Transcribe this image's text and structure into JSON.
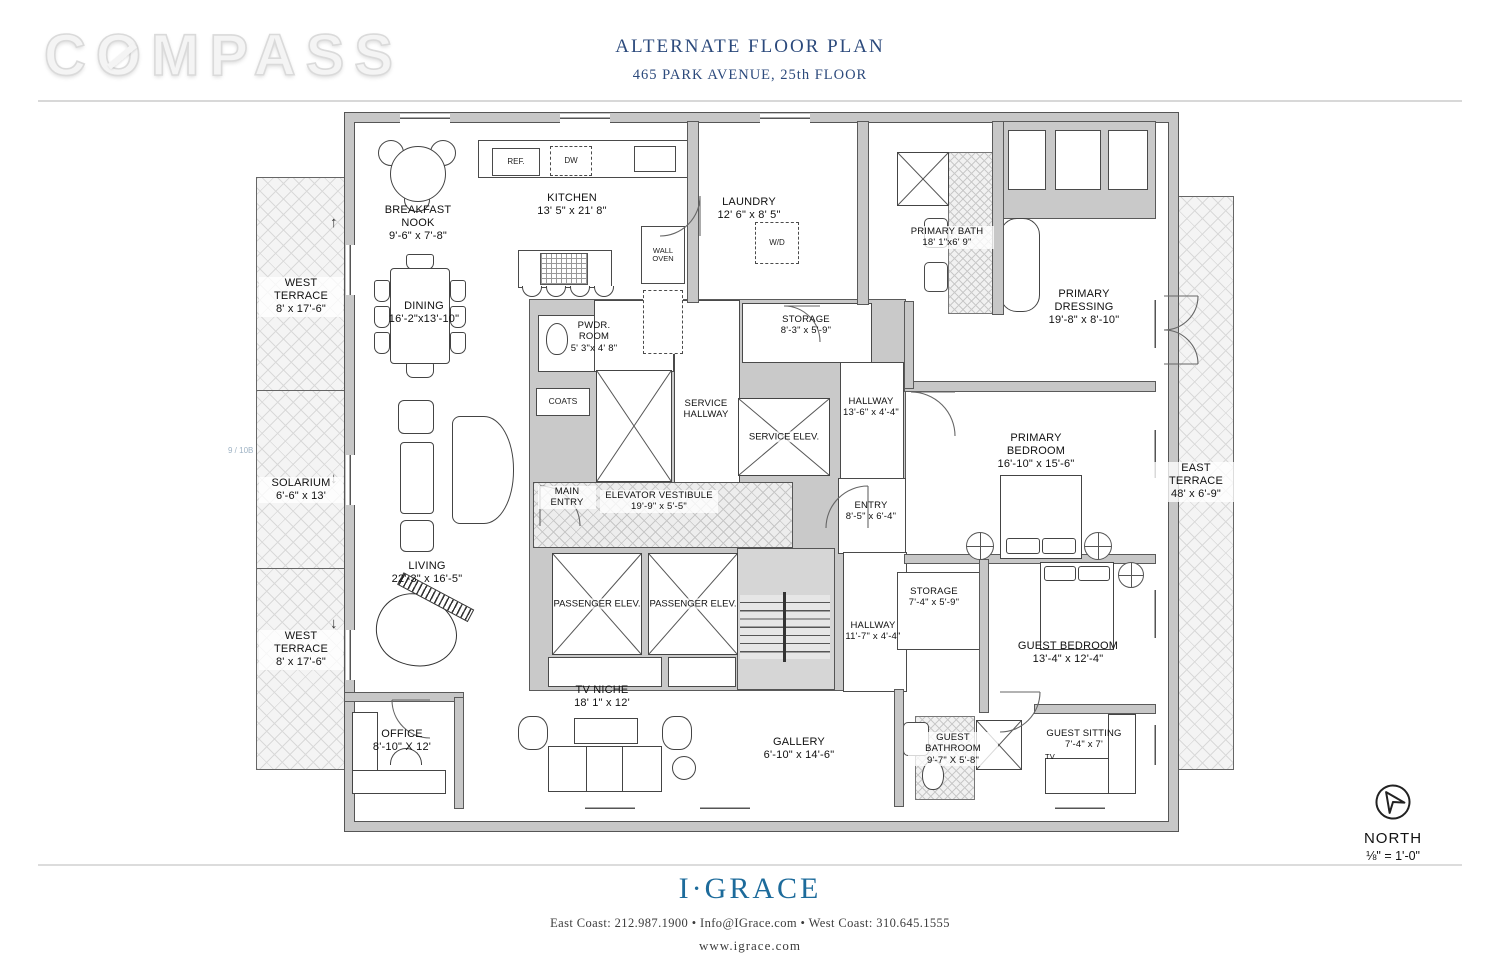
{
  "brand": {
    "pre": "C",
    "o": "O",
    "post": "MPASS"
  },
  "title": {
    "main": "ALTERNATE FLOOR PLAN",
    "sub": "465 PARK AVENUE, 25th FLOOR"
  },
  "colors": {
    "title_blue": "#2c4a7c",
    "igrace_blue": "#1d6b9b",
    "wall_gray": "#c7c7c7"
  },
  "rooms": [
    {
      "name": "BREAKFAST NOOK",
      "dims": "9'-6\" x 7'-8\""
    },
    {
      "name": "KITCHEN",
      "dims": "13' 5\" x 21' 8\""
    },
    {
      "name": "LAUNDRY",
      "dims": "12' 6\" x 8' 5\""
    },
    {
      "name": "PRIMARY BATH",
      "dims": "18' 1\"x6' 9\""
    },
    {
      "name": "PRIMARY DRESSING",
      "dims": "19'-8\" x 8'-10\""
    },
    {
      "name": "WEST TERRACE",
      "dims": "8' x 17'-6\""
    },
    {
      "name": "DINING",
      "dims": "16'-2\"x13'-10\""
    },
    {
      "name": "PWDR. ROOM",
      "dims": "5' 3\"x 4' 8\""
    },
    {
      "name": "STORAGE",
      "dims": "8'-3\" x 5'-9\""
    },
    {
      "name": "SERVICE HALLWAY",
      "dims": ""
    },
    {
      "name": "SERVICE ELEV.",
      "dims": ""
    },
    {
      "name": "HALLWAY",
      "dims": "13'-6\" x 4'-4\""
    },
    {
      "name": "PRIMARY BEDROOM",
      "dims": "16'-10\" x 15'-6\""
    },
    {
      "name": "SOLARIUM",
      "dims": "6'-6\" x 13'"
    },
    {
      "name": "MAIN ENTRY",
      "dims": ""
    },
    {
      "name": "ELEVATOR VESTIBULE",
      "dims": "19'-9\" x 5'-5\""
    },
    {
      "name": "ENTRY",
      "dims": "8'-5\" x 6'-4\""
    },
    {
      "name": "EAST TERRACE",
      "dims": "48' x 6'-9\""
    },
    {
      "name": "LIVING",
      "dims": "22'-3\" x 16'-5\""
    },
    {
      "name": "PASSENGER ELEV.",
      "dims": ""
    },
    {
      "name": "PASSENGER ELEV.",
      "dims": ""
    },
    {
      "name": "STORAGE",
      "dims": "7'-4\" x 5'-9\""
    },
    {
      "name": "HALLWAY",
      "dims": "11'-7\" x 4'-4\""
    },
    {
      "name": "GUEST BEDROOM",
      "dims": "13'-4\" x 12'-4\""
    },
    {
      "name": "WEST TERRACE",
      "dims": "8' x 17'-6\""
    },
    {
      "name": "TV NICHE",
      "dims": "18' 1\" x 12'"
    },
    {
      "name": "OFFICE",
      "dims": "8'-10\" X 12'"
    },
    {
      "name": "GALLERY",
      "dims": "6'-10\" x 14'-6\""
    },
    {
      "name": "GUEST BATHROOM",
      "dims": "9'-7\" X 5'-8\""
    },
    {
      "name": "GUEST SITTING",
      "dims": "7'-4\" x 7'"
    }
  ],
  "fixtures": {
    "ref": "REF.",
    "dw": "DW",
    "wd": "W/D",
    "wall_oven": "WALL OVEN",
    "coats": "COATS",
    "tv": "TV"
  },
  "annotation": "9 / 10B",
  "north": {
    "label": "NORTH",
    "scale": "⅛\" = 1'-0\""
  },
  "footer": {
    "brand": "I·GRACE",
    "contact": "East Coast: 212.987.1900   •   Info@IGrace.com   •   West Coast: 310.645.1555",
    "website": "www.igrace.com"
  }
}
